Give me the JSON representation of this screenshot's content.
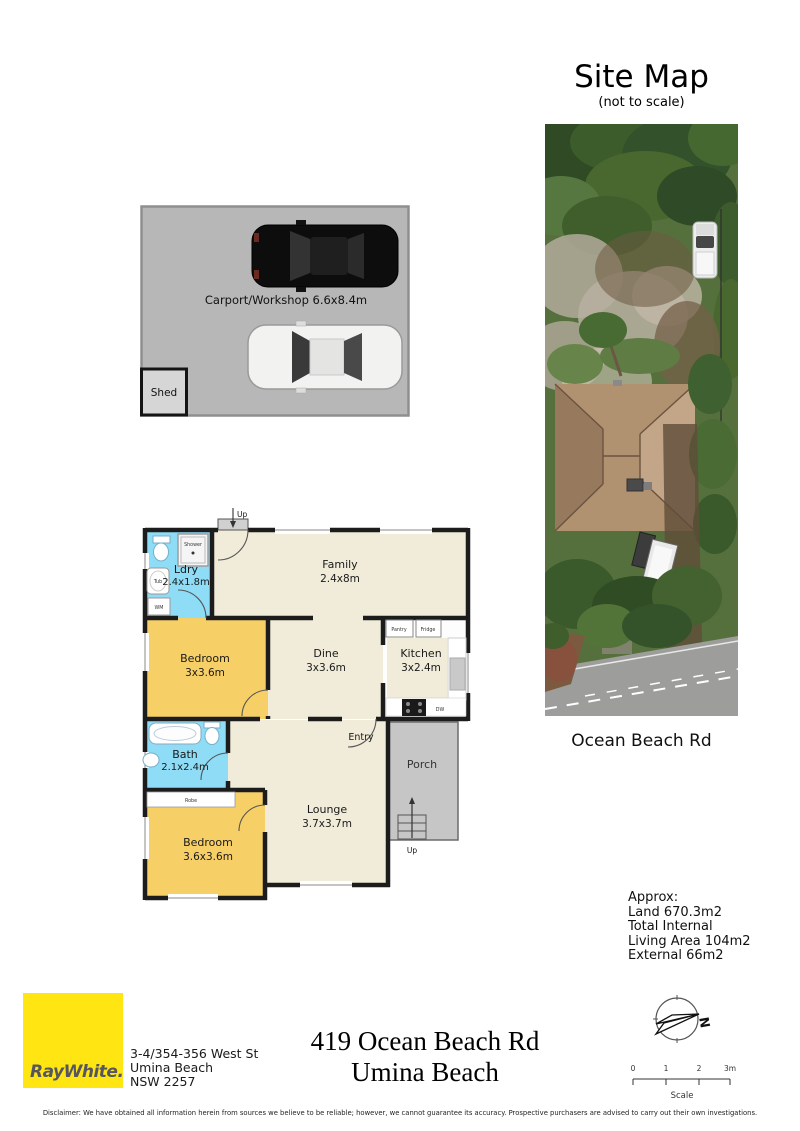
{
  "site_map": {
    "title": "Site Map",
    "subtitle": "(not to scale)",
    "road_label": "Ocean Beach Rd"
  },
  "carport": {
    "label": "Carport/Workshop 6.6x8.4m",
    "shed": "Shed"
  },
  "floorplan": {
    "family_name": "Family",
    "family_dims": "2.4x8m",
    "ldry_name": "Ldry",
    "ldry_dims": "2.4x1.8m",
    "bedroom1_name": "Bedroom",
    "bedroom1_dims": "3x3.6m",
    "dine_name": "Dine",
    "dine_dims": "3x3.6m",
    "kitchen_name": "Kitchen",
    "kitchen_dims": "3x2.4m",
    "bath_name": "Bath",
    "bath_dims": "2.1x2.4m",
    "bedroom2_name": "Bedroom",
    "bedroom2_dims": "3.6x3.6m",
    "lounge_name": "Lounge",
    "lounge_dims": "3.7x3.7m",
    "entry": "Entry",
    "porch": "Porch",
    "up": "Up",
    "shower": "Shower",
    "tub": "Tub",
    "wm": "WM",
    "robe": "Robe",
    "pantry": "Pantry",
    "fridge": "Fridge",
    "dw": "DW"
  },
  "areas": {
    "heading": "Approx:",
    "line1": "Land 670.3m2",
    "line2": "Total Internal",
    "line3": "Living Area 104m2",
    "line4": "External 66m2"
  },
  "branding": {
    "logo": "RayWhite.",
    "address1": "3-4/354-356 West St",
    "address2": "Umina Beach",
    "address3": "NSW 2257"
  },
  "property": {
    "title1": "419 Ocean Beach Rd",
    "title2": "Umina Beach"
  },
  "compass": {
    "north": "N"
  },
  "scale": {
    "t0": "0",
    "t1": "1",
    "t2": "2",
    "t3": "3m",
    "label": "Scale"
  },
  "colors": {
    "brand_yellow": "#ffe512",
    "room_beige": "#f0ecd9",
    "bedroom_yellow": "#f6cf67",
    "wet_blue": "#8edcf5",
    "porch_grey": "#c6c6c6",
    "carport_grey": "#b7b7b7"
  },
  "disclaimer": "Disclaimer: We have obtained all information herein from sources we believe to be reliable; however, we cannot guarantee its accuracy. Prospective purchasers are advised to carry out their own investigations."
}
